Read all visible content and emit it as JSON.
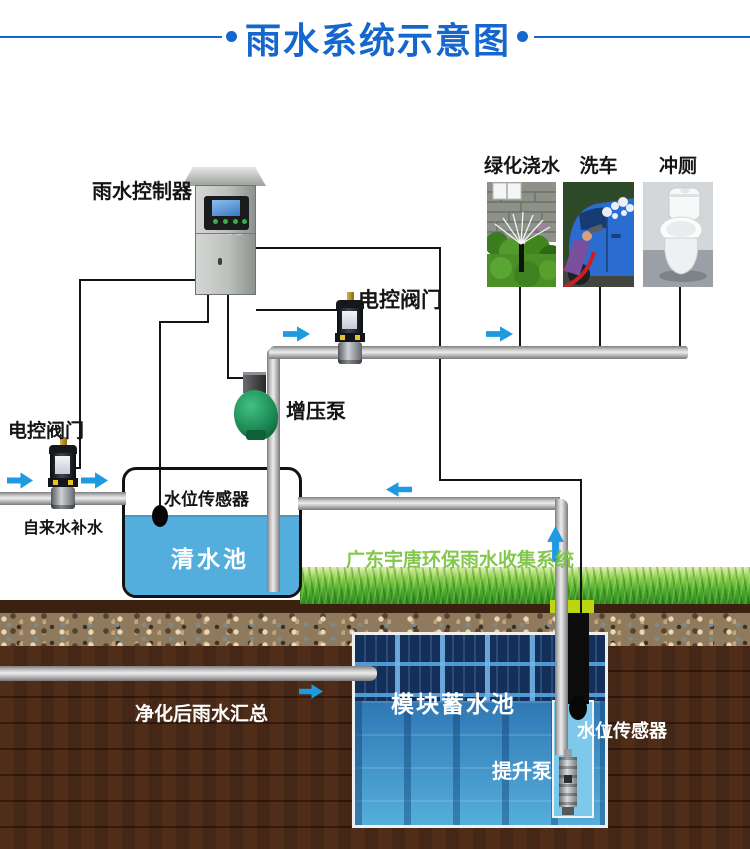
{
  "title": {
    "text": "雨水系统示意图"
  },
  "controller": {
    "label": "雨水控制器"
  },
  "usages": {
    "items": [
      {
        "label": "绿化浇水"
      },
      {
        "label": "洗车"
      },
      {
        "label": "冲厕"
      }
    ]
  },
  "valves": {
    "mid": {
      "label": "电控阀门"
    },
    "left": {
      "label": "电控阀门"
    }
  },
  "pumps": {
    "booster": {
      "label": "增压泵"
    },
    "lift": {
      "label": "提升泵"
    }
  },
  "tanks": {
    "clean": {
      "label": "清水池"
    },
    "module": {
      "label": "模块蓄水池"
    }
  },
  "sensors": {
    "clean": {
      "label": "水位传感器"
    },
    "module": {
      "label": "水位传感器"
    }
  },
  "notes": {
    "tap_water": "自来水补水",
    "brand": "广东宇唐环保雨水收集系统",
    "inflow": "净化后雨水汇总"
  },
  "colors": {
    "title_blue": "#1566cd",
    "arrow_blue": "#1e9be0",
    "water_blue": "#53aedd",
    "brand_green": "#7cc04a",
    "pump_green": "#1d8a55",
    "soil_brown": "#4f2d19",
    "module_dark": "#14305a",
    "module_light": "#55aeda"
  }
}
